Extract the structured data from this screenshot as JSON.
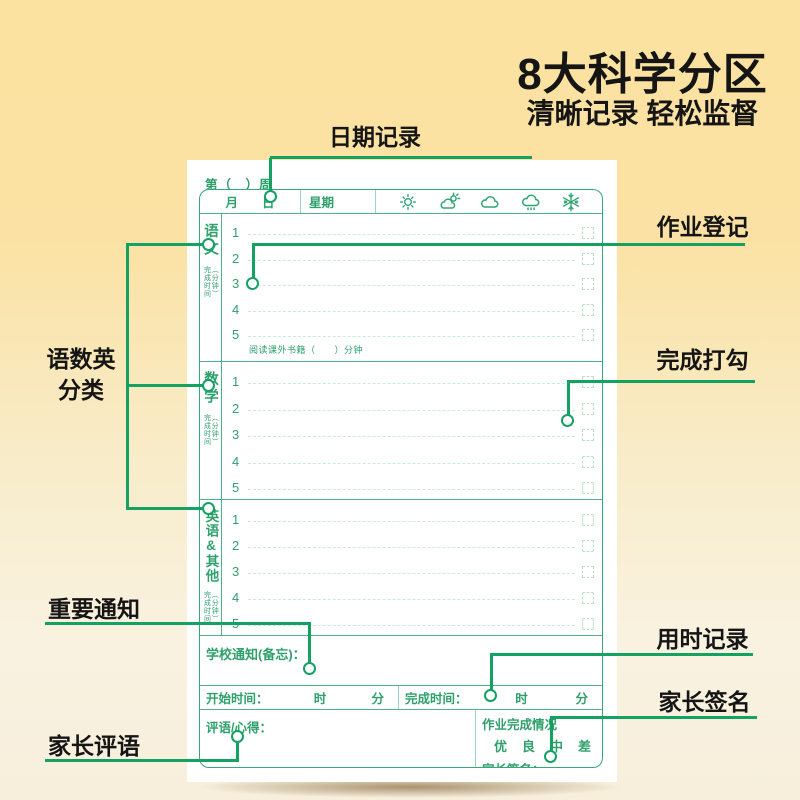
{
  "marketing": {
    "title": "8大科学分区",
    "subtitle": "清晰记录 轻松监督"
  },
  "callouts": {
    "date": "日期记录",
    "homework": "作业登记",
    "subjects_line1": "语数英",
    "subjects_line2": "分类",
    "check": "完成打勾",
    "notice": "重要通知",
    "time": "用时记录",
    "parent_comment": "家长评语",
    "parent_sign": "家长签名"
  },
  "form": {
    "week_label": "第（　）周",
    "header": {
      "month": "月",
      "day": "日",
      "weekday": "星期",
      "weather_icons": [
        "sun",
        "sun-behind-cloud",
        "cloud",
        "rain-cloud",
        "snowflake"
      ]
    },
    "sections": [
      {
        "name": "语文",
        "time_note": "完成时间",
        "time_unit": "（分钟）",
        "rows": [
          "1",
          "2",
          "3",
          "4",
          "5"
        ],
        "footer": "阅读课外书籍（　　）分钟"
      },
      {
        "name": "数学",
        "time_note": "完成时间",
        "time_unit": "（分钟）",
        "rows": [
          "1",
          "2",
          "3",
          "4",
          "5"
        ]
      },
      {
        "name": "英语&其他",
        "time_note": "完成时间",
        "time_unit": "（分钟）",
        "rows": [
          "1",
          "2",
          "3",
          "4",
          "5"
        ]
      }
    ],
    "notice_label": "学校通知(备忘)：",
    "start_time": {
      "label": "开始时间：",
      "hour": "时",
      "minute": "分"
    },
    "end_time": {
      "label": "完成时间：",
      "hour": "时",
      "minute": "分"
    },
    "comment_label": "评语/心得：",
    "completion": {
      "label": "作业完成情况",
      "options": [
        "优",
        "良",
        "中",
        "差"
      ]
    },
    "sign_label": "家长签名："
  },
  "colors": {
    "background_top": "#fce2a0",
    "background_bottom": "#f7efdc",
    "callout_green": "#14a262",
    "form_border_green": "#36a878",
    "form_text_green": "#2fa06c",
    "dashed_line_green": "#c9ebd8",
    "title_black": "#151515",
    "paper_white": "#ffffff"
  }
}
